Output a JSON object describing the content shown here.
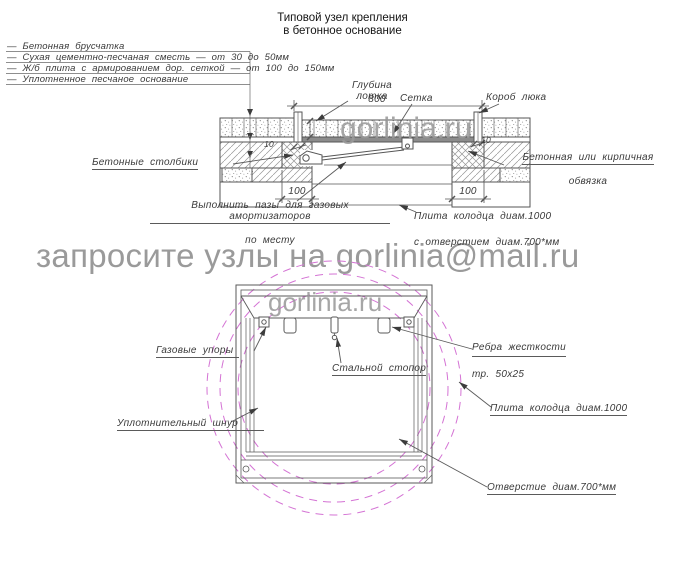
{
  "title": {
    "text": "Типовой узел крепления\nв бетонное основание"
  },
  "legend": {
    "items": [
      "—  Бетонная брусчатка",
      "—  Сухая цементно-песчаная сместь — от 30 до 50мм",
      "—  Ж/б плита с армированием дор. сеткой — от 100 до 150мм",
      "—  Уплотненное песчаное основание"
    ]
  },
  "section": {
    "labels": {
      "tray_depth": "Глубина\nлотка",
      "mesh": "Сетка",
      "hatch_box": "Короб люка",
      "columns": "Бетонные столбики",
      "binding_line1": "Бетонная или кирпичная",
      "binding_line2": "обвязка",
      "grooves_line1": "Выполнить пазы для газовых амортизаторов",
      "grooves_line2": "по месту",
      "slab_line1": "Плита колодца диам.1000",
      "slab_line2": "с отверстием диам.700*мм"
    },
    "dims": {
      "width": "800",
      "left_bearing": "100",
      "right_bearing": "100",
      "left_wall": "10",
      "right_wall": "10"
    }
  },
  "plan": {
    "labels": {
      "gas_struts": "Газовые упоры",
      "steel_stopper": "Стальной стопор",
      "ribs_line1": "Ребра жесткости",
      "ribs_line2": "тр. 50х25",
      "slab": "Плита колодца диам.1000",
      "seal_cord": "Уплотнительный шнур",
      "opening": "Отверстие диам.700*мм"
    }
  },
  "watermark": {
    "request": "запросите узлы на gorlinia@mail.ru",
    "site": "gorlinia.ru"
  },
  "colors": {
    "line": "#565656",
    "label": "#3a3a3a",
    "magenta": "#d473d4",
    "watermark": "#9a9a9a"
  }
}
